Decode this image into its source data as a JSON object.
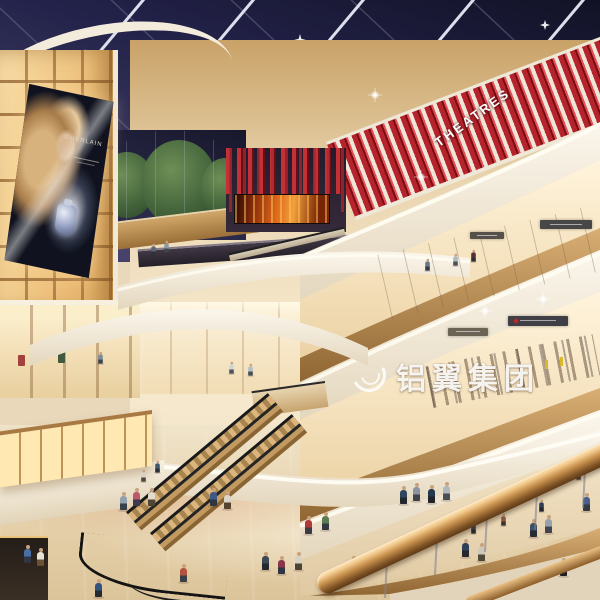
{
  "scene": {
    "theatres_sign": "THEATRES",
    "watermark_text": "铝翼集团",
    "billboard": {
      "brand": "GUERLAIN"
    }
  },
  "colors": {
    "ceiling_dark": "#1c1b33",
    "ceiling_light": "#3c3a5e",
    "beam": "#e6e7f0",
    "red_fascia": "#b5242c",
    "red_deep": "#7a0d13",
    "red_bright": "#e25056",
    "cream": "#f6efe0",
    "wood": "#c39a60",
    "wood_dark": "#8a6534",
    "glow": "#ffe8b2",
    "store_warm": "#fff3da",
    "floor": "#e9d8ba",
    "screen_fire": "#e06a1d",
    "tree": "#45663c"
  }
}
